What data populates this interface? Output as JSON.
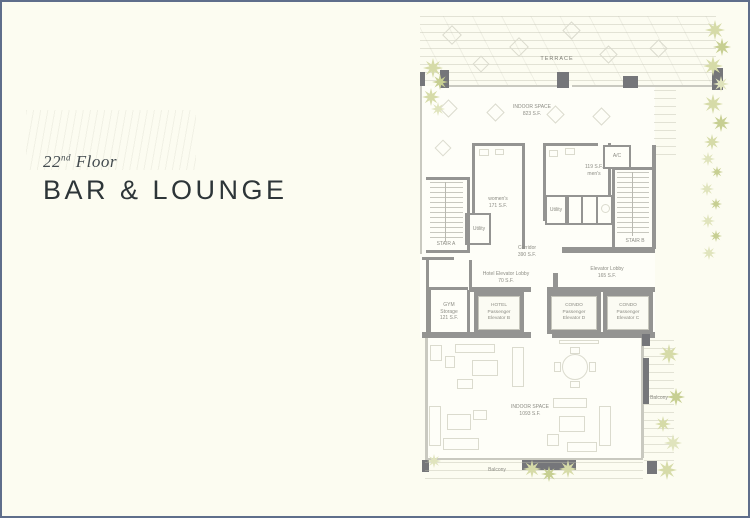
{
  "page": {
    "background_color": "#FCFCF1",
    "border_color": "#5F6E8B"
  },
  "title_block": {
    "floor_number": "22",
    "floor_ordinal": "nd",
    "floor_word": "Floor",
    "venue_title": "BAR & LOUNGE"
  },
  "floor_plan": {
    "colors": {
      "wall": "#949492",
      "wall_dark": "#75767A",
      "furniture_line": "#DBDBCE",
      "plant_green": "#D6DBA8",
      "label_text": "#8D8D85"
    },
    "rooms": {
      "terrace": {
        "label": "TERRACE"
      },
      "indoor_space_upper": {
        "label": "INDOOR SPACE",
        "area": "823 S.F."
      },
      "womens": {
        "label": "women's",
        "area": "171 S.F."
      },
      "mens": {
        "area": "119 S.F.",
        "label": "men's"
      },
      "ac": {
        "label": "A/C"
      },
      "utility_left": {
        "label": "Utility"
      },
      "utility_center": {
        "label": "Utility"
      },
      "stair_a": {
        "label": "STAIR A"
      },
      "stair_b": {
        "label": "STAIR B"
      },
      "corridor": {
        "label": "Corridor",
        "area": "390 S.F."
      },
      "hotel_elevator_lobby": {
        "label": "Hotel Elevator Lobby",
        "area": "70 S.F."
      },
      "elevator_lobby": {
        "label": "Elevator Lobby",
        "area": "165 S.F."
      },
      "gym_storage": {
        "label_line1": "GYM",
        "label_line2": "Storage",
        "area": "121 S.F."
      },
      "elevator_hotel_b": {
        "brand": "HOTEL",
        "type": "Passenger",
        "unit": "Elevator B"
      },
      "elevator_condo_d": {
        "brand": "CONDO",
        "type": "Passenger",
        "unit": "Elevator D"
      },
      "elevator_condo_c": {
        "brand": "CONDO",
        "type": "Passenger",
        "unit": "Elevator C"
      },
      "indoor_space_lower": {
        "label": "INDOOR SPACE",
        "area": "1093 S.F."
      },
      "balcony_right": {
        "label": "Balcony"
      },
      "balcony_bottom": {
        "label": "Balcony"
      }
    }
  }
}
